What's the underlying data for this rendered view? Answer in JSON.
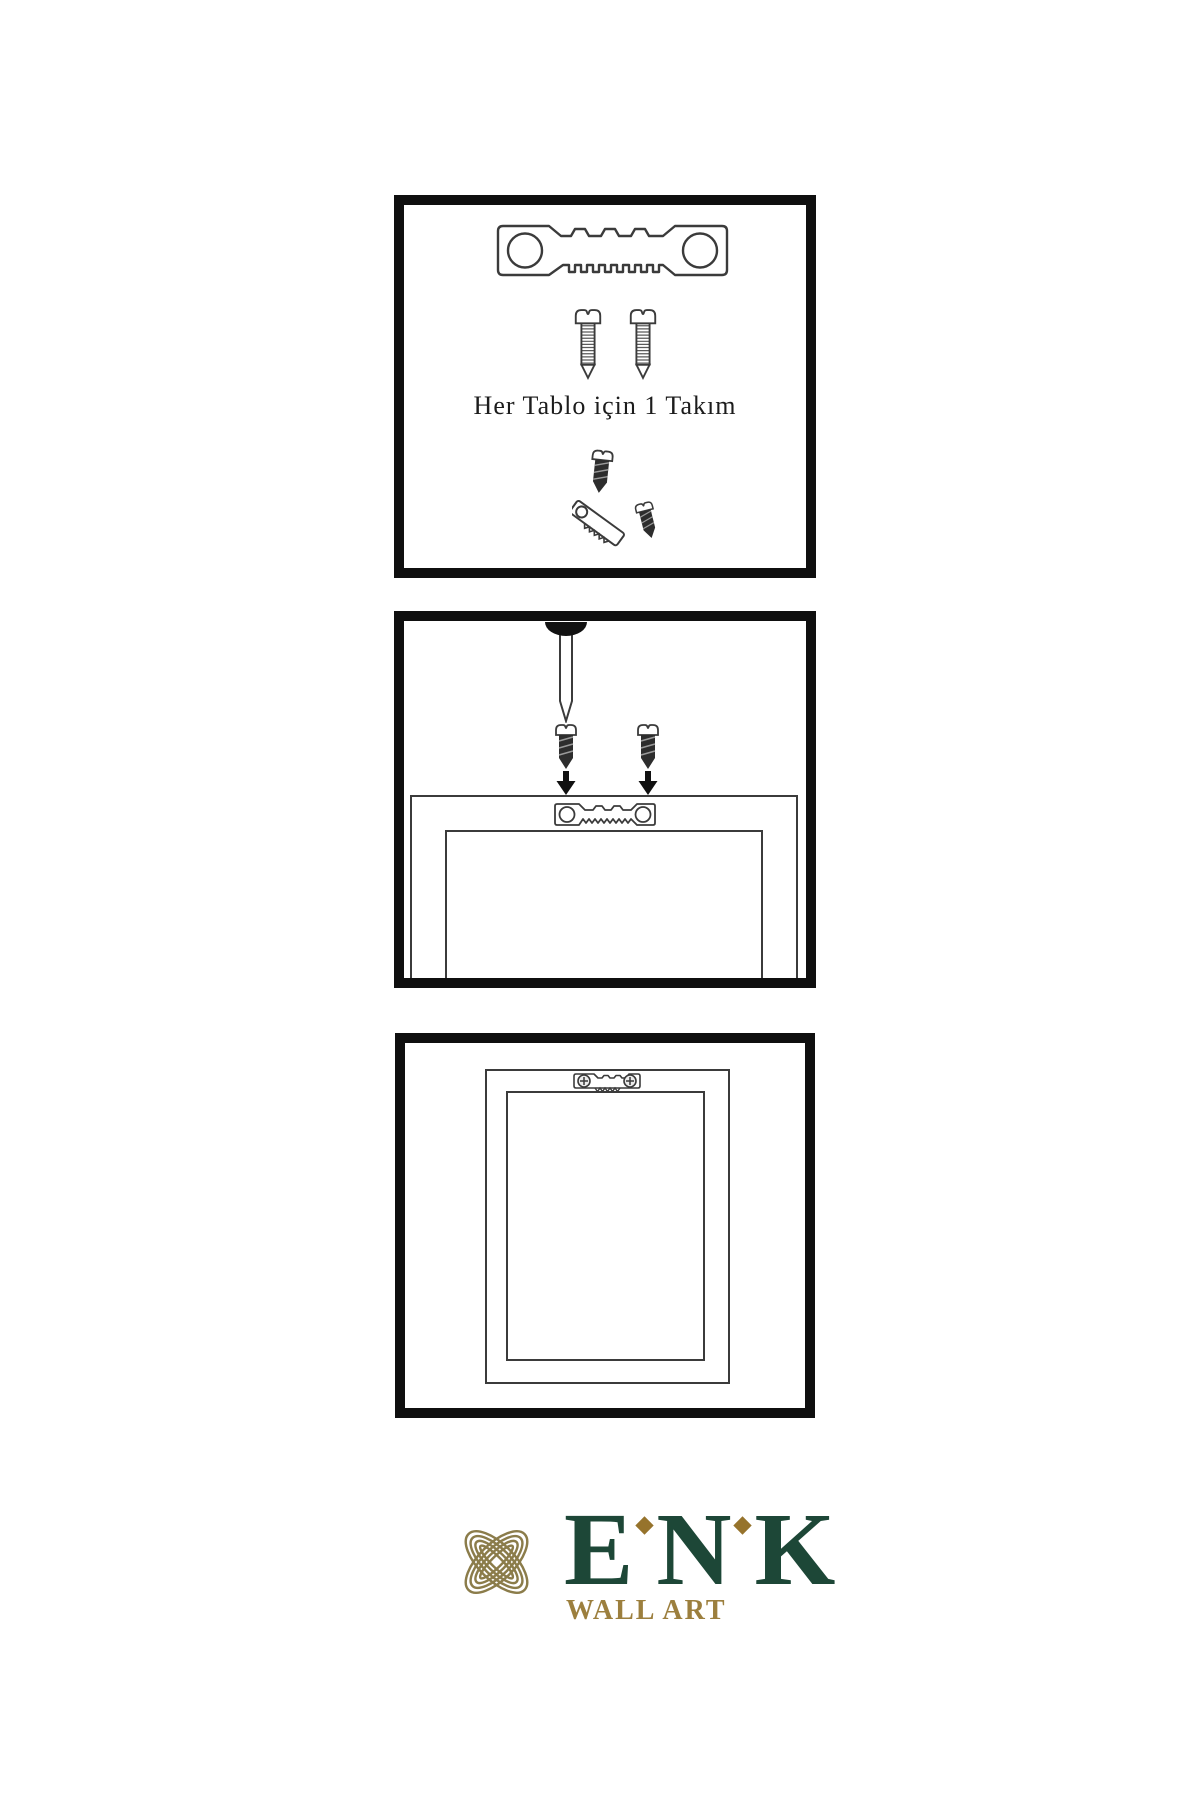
{
  "panels": {
    "kit": {
      "caption": "Her Tablo için 1 Takım",
      "illustrations": [
        "sawtooth-hanger-plate",
        "mounting-screw",
        "mounting-screw",
        "screw-into-hanger-detail"
      ]
    },
    "install": {
      "illustrations": [
        "wall-nail",
        "screw-with-down-arrow",
        "screw-with-down-arrow",
        "frame-back-with-sawtooth-hanger"
      ]
    },
    "result": {
      "illustrations": [
        "frame-back-with-mounted-hanger"
      ]
    }
  },
  "brand": {
    "name": "ENK",
    "letters": [
      "E",
      "N",
      "K"
    ],
    "tagline": "WALL ART",
    "colors": {
      "knot_gold": "#8b7c4a",
      "name_green": "#1d4737",
      "tagline_gold": "#9c7f3e",
      "accent_gold": "#96732c"
    }
  },
  "drawing": {
    "ink": "#3b3b3b",
    "solid": "#111111",
    "panel_border": "#0f0f0f"
  }
}
